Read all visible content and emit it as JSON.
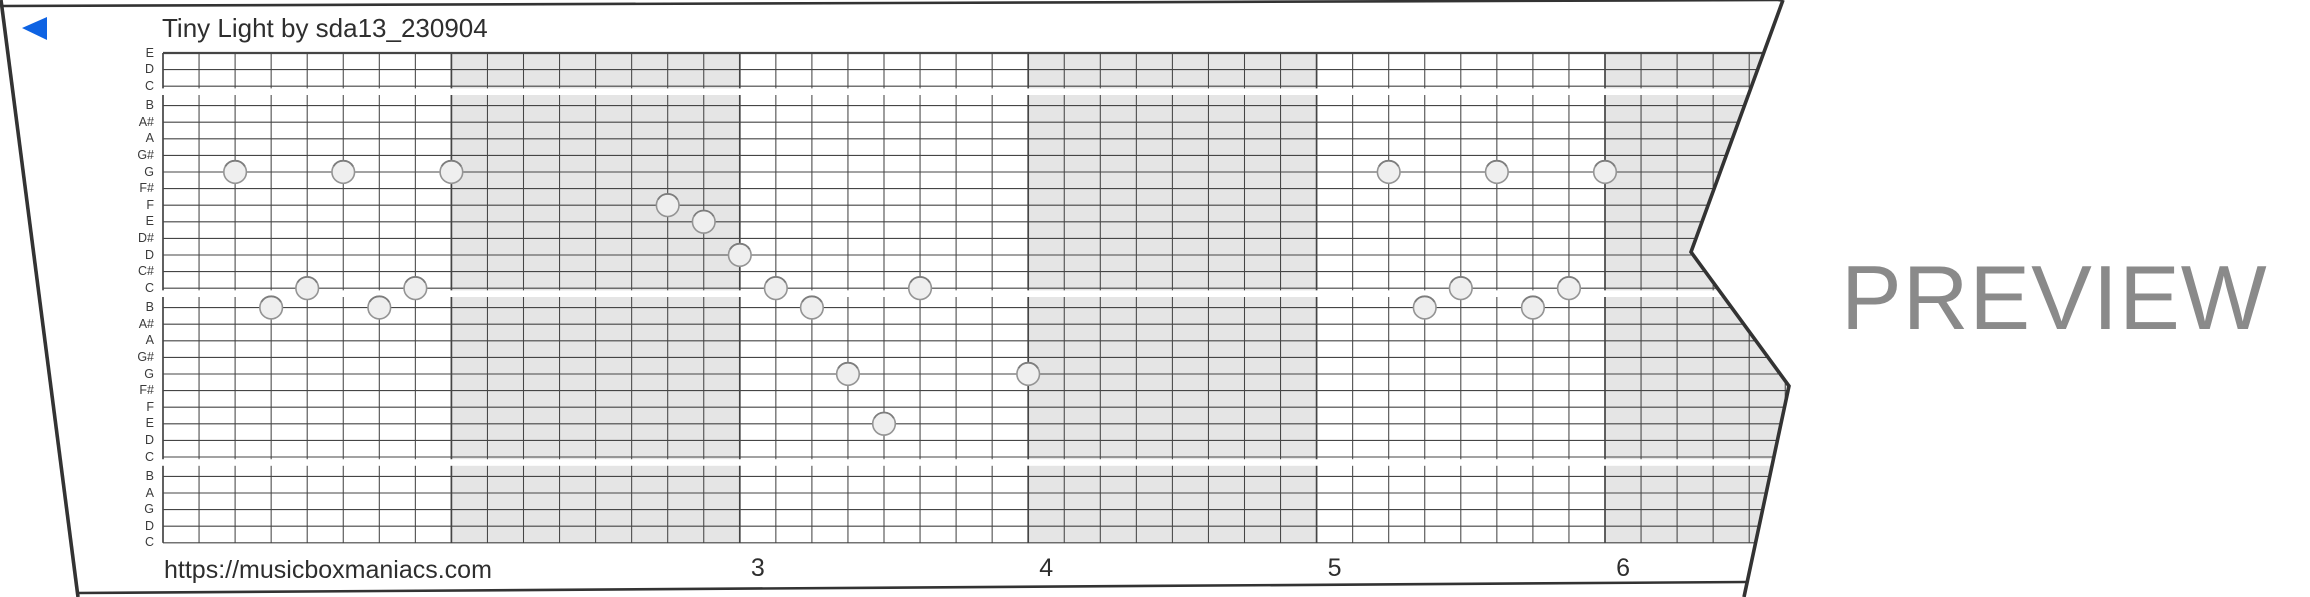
{
  "title": "Tiny Light by sda13_230904",
  "watermark": "PREVIEW",
  "footer": {
    "url": "https://musicboxmaniacs.com"
  },
  "colors": {
    "accent_blue": "#0e63e3",
    "strip_border": "#333333",
    "grid_line": "#454545",
    "measure_shading": "#e5e5e5",
    "note_fill": "#efefef",
    "note_stroke": "#949494",
    "note_top_shade": "#7d7d7d",
    "text_dark": "#2e2e2e",
    "note_label_color": "#3a3a3a",
    "watermark_gray": "#8a8a8a"
  },
  "note_labels": [
    "E",
    "D",
    "C",
    "B",
    "A#",
    "A",
    "G#",
    "G",
    "F#",
    "F",
    "E",
    "D#",
    "D",
    "C#",
    "C",
    "B",
    "A#",
    "A",
    "G#",
    "G",
    "F#",
    "F",
    "E",
    "D",
    "C",
    "B",
    "A",
    "G",
    "D",
    "C"
  ],
  "measure_numbers": [
    {
      "label": "3",
      "beat": 16
    },
    {
      "label": "4",
      "beat": 24
    },
    {
      "label": "5",
      "beat": 32
    },
    {
      "label": "6",
      "beat": 40
    }
  ],
  "shaded_measures_beats": [
    [
      8,
      16
    ],
    [
      24,
      32
    ],
    [
      40,
      48
    ]
  ],
  "notes": [
    {
      "beat": 2,
      "pitch": "G",
      "line": 7
    },
    {
      "beat": 3,
      "pitch": "B",
      "line": 15
    },
    {
      "beat": 4,
      "pitch": "C",
      "line": 14
    },
    {
      "beat": 5,
      "pitch": "G",
      "line": 7
    },
    {
      "beat": 6,
      "pitch": "B",
      "line": 15
    },
    {
      "beat": 7,
      "pitch": "C",
      "line": 14
    },
    {
      "beat": 8,
      "pitch": "G",
      "line": 7
    },
    {
      "beat": 14,
      "pitch": "F",
      "line": 9
    },
    {
      "beat": 15,
      "pitch": "E",
      "line": 10
    },
    {
      "beat": 16,
      "pitch": "D",
      "line": 12
    },
    {
      "beat": 17,
      "pitch": "C",
      "line": 14
    },
    {
      "beat": 18,
      "pitch": "B",
      "line": 15
    },
    {
      "beat": 19,
      "pitch": "G",
      "line": 19
    },
    {
      "beat": 20,
      "pitch": "E",
      "line": 22
    },
    {
      "beat": 21,
      "pitch": "C",
      "line": 14
    },
    {
      "beat": 24,
      "pitch": "G",
      "line": 19
    },
    {
      "beat": 34,
      "pitch": "G",
      "line": 7
    },
    {
      "beat": 35,
      "pitch": "B",
      "line": 15
    },
    {
      "beat": 36,
      "pitch": "C",
      "line": 14
    },
    {
      "beat": 37,
      "pitch": "G",
      "line": 7
    },
    {
      "beat": 38,
      "pitch": "B",
      "line": 15
    },
    {
      "beat": 39,
      "pitch": "C",
      "line": 14
    },
    {
      "beat": 40,
      "pitch": "G",
      "line": 7
    }
  ]
}
